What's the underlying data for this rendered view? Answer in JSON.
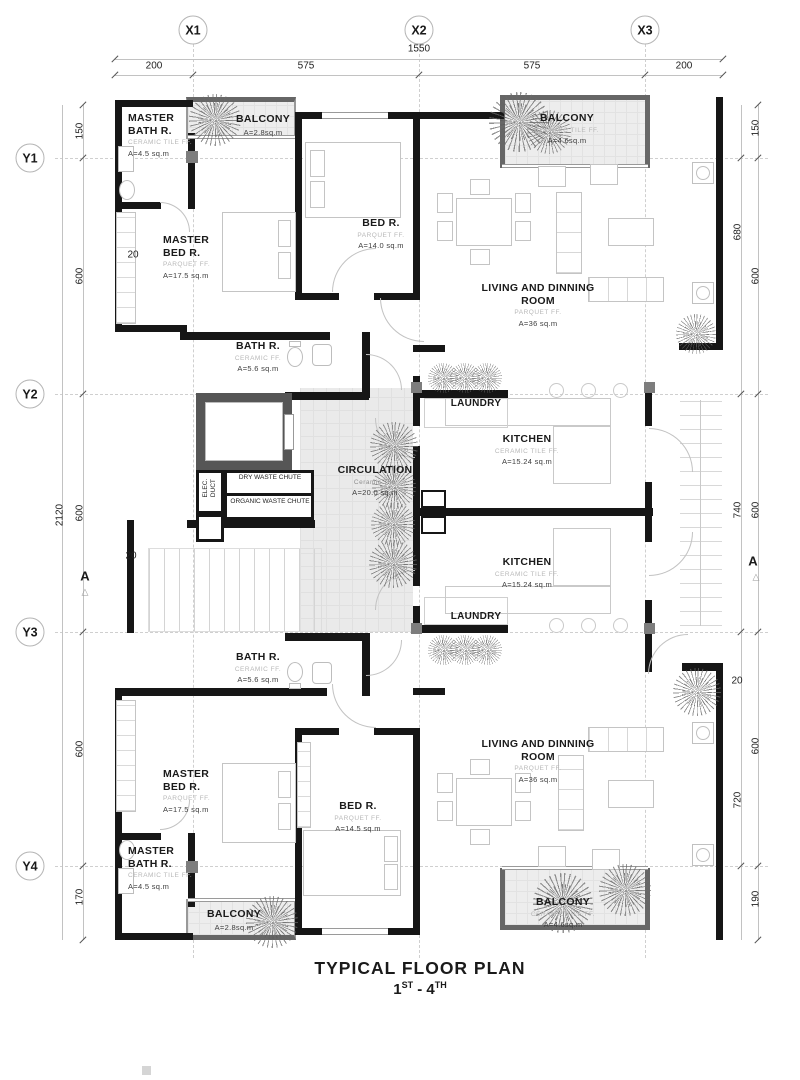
{
  "title": {
    "main": "TYPICAL FLOOR PLAN",
    "range_from": "1",
    "range_from_sup": "ST",
    "range_dash": " - ",
    "range_to": "4",
    "range_to_sup": "TH"
  },
  "axes": {
    "x": [
      "X1",
      "X2",
      "X3"
    ],
    "y": [
      "Y1",
      "Y2",
      "Y3",
      "Y4"
    ]
  },
  "dims": {
    "top": {
      "overall": "1550",
      "segments": [
        "200",
        "575",
        "575",
        "200"
      ]
    },
    "left": {
      "overall": "2120",
      "segments": [
        "150",
        "600",
        "600",
        "600",
        "170"
      ]
    },
    "right_inner": [
      "680",
      "740",
      "720"
    ],
    "right_outer": [
      "150",
      "600",
      "600",
      "600",
      "190"
    ],
    "wall_marks": [
      "20",
      "20",
      "20"
    ]
  },
  "section_markers": {
    "left": "A",
    "right": "A",
    "triangle": "△"
  },
  "rooms": {
    "master_bath_u": {
      "name": "MASTER BATH R.",
      "finish": "CERAMIC TILE FF.",
      "area": "A=4.5 sq.m"
    },
    "balcony_tl": {
      "name": "BALCONY",
      "area": "A=2.8sq.m"
    },
    "master_bed_u": {
      "name": "MASTER BED R.",
      "finish": "PARQUET FF.",
      "area": "A=17.5 sq.m"
    },
    "bed_u": {
      "name": "BED R.",
      "finish": "PARQUET FF.",
      "area": "A=14.0 sq.m"
    },
    "living_u": {
      "name": "LIVING AND DINNING ROOM",
      "finish": "PARQUET FF.",
      "area": "A=36 sq.m"
    },
    "balcony_tr": {
      "name": "BALCONY",
      "finish": "CERAMIC TILE FF.",
      "area": "A=4.6sq.m"
    },
    "bath_u": {
      "name": "BATH R.",
      "finish": "CERAMIC FF.",
      "area": "A=5.6 sq.m"
    },
    "laundry_u": {
      "name": "LAUNDRY"
    },
    "kitchen_u": {
      "name": "KITCHEN",
      "finish": "CERAMIC TILE FF.",
      "area": "A=15.24 sq.m"
    },
    "circulation": {
      "name": "CIRCULATION",
      "finish": "Ceramic Tile",
      "area": "A=20.0 sq.m"
    },
    "kitchen_l": {
      "name": "KITCHEN",
      "finish": "CERAMIC TILE FF.",
      "area": "A=15.24 sq.m"
    },
    "laundry_l": {
      "name": "LAUNDRY"
    },
    "bath_l": {
      "name": "BATH R.",
      "finish": "CERAMIC FF.",
      "area": "A=5.6 sq.m"
    },
    "master_bed_l": {
      "name": "MASTER BED R.",
      "finish": "PARQUET FF.",
      "area": "A=17.5 sq.m"
    },
    "bed_l": {
      "name": "BED R.",
      "finish": "PARQUET FF.",
      "area": "A=14.5 sq.m"
    },
    "master_bath_l": {
      "name": "MASTER BATH R.",
      "finish": "CERAMIC TILE FF.",
      "area": "A=4.5 sq.m"
    },
    "balcony_bl": {
      "name": "BALCONY",
      "area": "A=2.8sq.m"
    },
    "living_l": {
      "name": "LIVING AND DINNING ROOM",
      "finish": "PARQUET FF.",
      "area": "A=36 sq.m"
    },
    "balcony_br": {
      "name": "BALCONY",
      "finish": "CERAMIC TILE FF.",
      "area": "A=4.6sq.m"
    }
  },
  "core": {
    "elec_duct": "ELEC. DUCT",
    "dry_chute": "DRY WASTE CHUTE",
    "organic_chute": "ORGANIC WASTE CHUTE"
  }
}
